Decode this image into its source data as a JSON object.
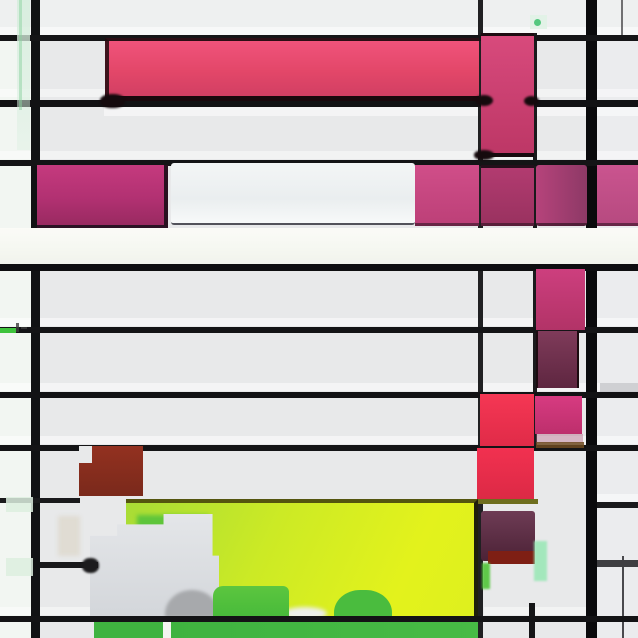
{
  "artwork": {
    "title": "Abstract Mondrian-style glitch composition",
    "canvas": {
      "width": 638,
      "height": 638,
      "background": "#e8e9ea"
    },
    "palette": {
      "ground": "#e8e9ea",
      "line_black": "#121214",
      "pink_bright": "#e84a71",
      "magenta": "#b23172",
      "red": "#ee3150",
      "brick": "#8a2d1e",
      "maroon": "#6f2f4c",
      "chartreuse": "#d8ef1f",
      "green": "#42b742",
      "white_band": "#f7f8f3",
      "mint": "#ddefe2"
    },
    "layers": [
      {
        "name": "left-column-tint",
        "x": 0,
        "y": 0,
        "w": 33,
        "h": 638,
        "css": {
          "background": "#f2f6f2"
        }
      },
      {
        "name": "right-column-tint",
        "x": 597,
        "y": 0,
        "w": 41,
        "h": 638,
        "css": {
          "background": "#ebecee"
        }
      },
      {
        "name": "top-band-tint",
        "x": 0,
        "y": 0,
        "w": 638,
        "h": 35,
        "css": {
          "background": "#eef0f0"
        }
      },
      {
        "name": "row-bevel",
        "x": 0,
        "y": 27,
        "w": 638,
        "h": 9,
        "css": {
          "background": "rgba(255,255,255,0.5)"
        }
      },
      {
        "name": "row-bevel",
        "x": 0,
        "y": 89,
        "w": 638,
        "h": 8,
        "css": {
          "background": "rgba(255,255,255,0.45)"
        }
      },
      {
        "name": "row-bevel",
        "x": 104,
        "y": 104,
        "w": 534,
        "h": 12,
        "css": {
          "background": "rgba(255,255,255,0.5)"
        }
      },
      {
        "name": "row-bevel",
        "x": 0,
        "y": 151,
        "w": 638,
        "h": 8,
        "css": {
          "background": "rgba(255,255,255,0.45)"
        }
      },
      {
        "name": "row-bevel",
        "x": 0,
        "y": 318,
        "w": 638,
        "h": 8,
        "css": {
          "background": "rgba(255,255,255,0.5)"
        }
      },
      {
        "name": "row-bevel",
        "x": 0,
        "y": 383,
        "w": 638,
        "h": 8,
        "css": {
          "background": "rgba(255,255,255,0.5)"
        }
      },
      {
        "name": "row-bevel",
        "x": 0,
        "y": 436,
        "w": 638,
        "h": 8,
        "css": {
          "background": "rgba(255,255,255,0.5)"
        }
      },
      {
        "name": "row-bevel",
        "x": 597,
        "y": 494,
        "w": 41,
        "h": 8,
        "css": {
          "background": "rgba(255,255,255,0.5)"
        }
      },
      {
        "name": "row-bevel",
        "x": 0,
        "y": 607,
        "w": 94,
        "h": 8,
        "css": {
          "background": "rgba(255,255,255,0.45)"
        }
      },
      {
        "name": "row-bevel",
        "x": 484,
        "y": 607,
        "w": 113,
        "h": 8,
        "css": {
          "background": "rgba(255,255,255,0.45)"
        }
      },
      {
        "name": "v-line-left",
        "x": 31,
        "y": 0,
        "w": 9,
        "h": 638,
        "css": {
          "background": "#111214"
        }
      },
      {
        "name": "v-line-center-thin",
        "x": 478,
        "y": 0,
        "w": 5,
        "h": 638,
        "css": {
          "background": "#202022"
        }
      },
      {
        "name": "v-line-right-thick",
        "x": 586,
        "y": 0,
        "w": 11,
        "h": 638,
        "css": {
          "background": "#0a0a0c"
        }
      },
      {
        "name": "v-line-mid-partial",
        "x": 533,
        "y": 33,
        "w": 4,
        "h": 415,
        "css": {
          "background": "#1a1a1c"
        }
      },
      {
        "name": "v-line-faint-top-right",
        "x": 621,
        "y": 0,
        "w": 2,
        "h": 37,
        "css": {
          "background": "rgba(70,70,72,0.75)"
        }
      },
      {
        "name": "v-line-faint-bottom-right",
        "x": 622,
        "y": 556,
        "w": 2,
        "h": 82,
        "css": {
          "background": "rgba(45,45,48,0.85)"
        }
      },
      {
        "name": "v-line-stub-bottom",
        "x": 529,
        "y": 603,
        "w": 6,
        "h": 35,
        "css": {
          "background": "#151517"
        }
      },
      {
        "name": "h-line-1",
        "x": 0,
        "y": 35,
        "w": 638,
        "h": 6,
        "css": {
          "background": "#151517"
        }
      },
      {
        "name": "h-line-2",
        "x": 0,
        "y": 100,
        "w": 638,
        "h": 7,
        "css": {
          "background": "#121214"
        }
      },
      {
        "name": "h-line-3",
        "x": 0,
        "y": 160,
        "w": 638,
        "h": 6,
        "css": {
          "background": "#141416"
        }
      },
      {
        "name": "h-line-6",
        "x": 0,
        "y": 327,
        "w": 638,
        "h": 6,
        "css": {
          "background": "#141416"
        }
      },
      {
        "name": "h-line-7",
        "x": 0,
        "y": 392,
        "w": 638,
        "h": 6,
        "css": {
          "background": "#121214"
        }
      },
      {
        "name": "h-line-8",
        "x": 0,
        "y": 445,
        "w": 638,
        "h": 6,
        "css": {
          "background": "#141416"
        }
      },
      {
        "name": "h-line-9-left",
        "x": 0,
        "y": 498,
        "w": 80,
        "h": 5,
        "css": {
          "background": "#1a1a1c"
        }
      },
      {
        "name": "h-line-9-right",
        "x": 597,
        "y": 502,
        "w": 41,
        "h": 6,
        "css": {
          "background": "#1a1a1c"
        }
      },
      {
        "name": "h-line-10-right",
        "x": 597,
        "y": 560,
        "w": 41,
        "h": 7,
        "css": {
          "background": "#3f3f42"
        }
      },
      {
        "name": "right-gray-bar",
        "x": 600,
        "y": 383,
        "w": 38,
        "h": 9,
        "css": {
          "background": "rgba(120,120,128,0.3)"
        }
      },
      {
        "name": "pink-bar",
        "x": 105,
        "y": 38,
        "w": 374,
        "h": 63,
        "css": {
          "background": "linear-gradient(180deg,#f0537b,#e34769 55%,#d23f63)",
          "borderTop": "3px solid #2c0e15",
          "borderBottom": "5px solid #1a090d",
          "borderLeft": "4px solid rgba(30,10,14,0.85)",
          "boxSizing": "border-box"
        }
      },
      {
        "name": "top-pink-column",
        "x": 481,
        "y": 33,
        "w": 53,
        "h": 124,
        "css": {
          "background": "linear-gradient(180deg,#d84a7c,#bd3766)",
          "borderTop": "3px solid #1c0b10",
          "borderBottom": "4px solid #170a0e",
          "boxSizing": "border-box"
        }
      },
      {
        "name": "smudge-bar-corner",
        "x": 100,
        "y": 94,
        "w": 25,
        "h": 14,
        "css": {
          "background": "#150a0d",
          "borderRadius": "45%",
          "filter": "blur(1px)"
        }
      },
      {
        "name": "smudge-cross-left",
        "x": 475,
        "y": 95,
        "w": 18,
        "h": 11,
        "css": {
          "background": "#150a0d",
          "borderRadius": "50%",
          "filter": "blur(1px)"
        }
      },
      {
        "name": "smudge-cross-right",
        "x": 524,
        "y": 96,
        "w": 15,
        "h": 10,
        "css": {
          "background": "#150a0d",
          "borderRadius": "50%",
          "filter": "blur(1px)"
        }
      },
      {
        "name": "smudge-column-bottom",
        "x": 474,
        "y": 150,
        "w": 20,
        "h": 10,
        "css": {
          "background": "#150a0d",
          "borderRadius": "45%",
          "filter": "blur(1px)"
        }
      },
      {
        "name": "mid-magenta-block",
        "x": 37,
        "y": 165,
        "w": 131,
        "h": 63,
        "css": {
          "background": "linear-gradient(180deg,#c53a7e,#b23172 55%,#992a61)",
          "borderBottom": "3px solid #2b1224",
          "borderRight": "4px solid #2a1120",
          "boxSizing": "border-box"
        }
      },
      {
        "name": "mid-light-block",
        "x": 171,
        "y": 163,
        "w": 244,
        "h": 62,
        "css": {
          "background": "linear-gradient(180deg,#f3f5f6,#eaeeef 60%,#f7f9f9)",
          "borderBottom": "2px solid #52525a",
          "borderRadius": "3px",
          "boxSizing": "border-box"
        }
      },
      {
        "name": "mid-pink-block-1",
        "x": 415,
        "y": 165,
        "w": 64,
        "h": 61,
        "css": {
          "background": "linear-gradient(180deg,#d04e89,#bd4078)",
          "borderBottom": "3px solid rgba(60,20,40,0.7)",
          "boxSizing": "border-box"
        }
      },
      {
        "name": "mid-pink-block-2",
        "x": 481,
        "y": 165,
        "w": 53,
        "h": 61,
        "css": {
          "background": "linear-gradient(180deg,#b23b70,#9a3260)",
          "borderTop": "3px solid #240f1b",
          "borderBottom": "3px solid rgba(50,18,34,0.7)",
          "boxSizing": "border-box"
        }
      },
      {
        "name": "mid-purple-block",
        "x": 536,
        "y": 165,
        "w": 51,
        "h": 61,
        "css": {
          "background": "linear-gradient(90deg,#b6437b,#8d3966)",
          "borderRadius": "3px",
          "borderBottom": "3px solid rgba(50,18,34,0.7)",
          "boxSizing": "border-box"
        }
      },
      {
        "name": "mid-pink-block-3",
        "x": 597,
        "y": 165,
        "w": 41,
        "h": 61,
        "css": {
          "background": "linear-gradient(180deg,#ca548f,#b74a80)",
          "borderBottom": "3px solid rgba(60,20,40,0.7)",
          "boxSizing": "border-box"
        }
      },
      {
        "name": "white-band",
        "x": 0,
        "y": 228,
        "w": 638,
        "h": 36,
        "css": {
          "background": "linear-gradient(180deg,#fbfbf7,#f6f8f2 50%,#f1f3ec)"
        }
      },
      {
        "name": "h-line-5",
        "x": 0,
        "y": 264,
        "w": 638,
        "h": 7,
        "css": {
          "background": "#0e0e10"
        }
      },
      {
        "name": "lower-pink-block",
        "x": 536,
        "y": 269,
        "w": 49,
        "h": 61,
        "css": {
          "background": "linear-gradient(180deg,#cd3f7e,#b23367)"
        }
      },
      {
        "name": "maroon-block",
        "x": 536,
        "y": 331,
        "w": 43,
        "h": 57,
        "css": {
          "background": "linear-gradient(180deg,#7f3b5a,#5e2640)",
          "borderLeft": "2px solid #1c0b10",
          "borderRight": "2px solid #1c0b10",
          "boxSizing": "border-box"
        }
      },
      {
        "name": "red-block-a",
        "x": 480,
        "y": 394,
        "w": 54,
        "h": 52,
        "css": {
          "background": "linear-gradient(180deg,#f53754,#e02b48)"
        }
      },
      {
        "name": "bright-pink-block",
        "x": 535,
        "y": 396,
        "w": 47,
        "h": 38,
        "css": {
          "background": "linear-gradient(180deg,#d73b81,#bd2f6c)"
        }
      },
      {
        "name": "pink-fade-strip",
        "x": 536,
        "y": 434,
        "w": 47,
        "h": 9,
        "css": {
          "background": "rgba(170,90,120,0.4)"
        }
      },
      {
        "name": "brown-line",
        "x": 536,
        "y": 442,
        "w": 48,
        "h": 6,
        "css": {
          "background": "rgba(110,74,32,0.85)"
        }
      },
      {
        "name": "red-block-b",
        "x": 477,
        "y": 448,
        "w": 57,
        "h": 52,
        "css": {
          "background": "linear-gradient(180deg,#f13150,#dc2945)"
        }
      },
      {
        "name": "brick-red-block",
        "x": 79,
        "y": 446,
        "w": 64,
        "h": 50,
        "css": {
          "background": "linear-gradient(180deg,#933120,#7a291b)"
        }
      },
      {
        "name": "brick-notch",
        "x": 79,
        "y": 446,
        "w": 13,
        "h": 17,
        "css": {
          "background": "#e8e9ea"
        }
      },
      {
        "name": "olive-line",
        "x": 477,
        "y": 499,
        "w": 61,
        "h": 5,
        "css": {
          "background": "#6e6e1e"
        }
      },
      {
        "name": "chartreuse-block",
        "x": 126,
        "y": 499,
        "w": 352,
        "h": 118,
        "css": {
          "background": "linear-gradient(115deg,#a8dc36,#ccea25 40%,#e3f21c 78%,#def01e)",
          "borderTop": "4px solid #54550f",
          "borderRight": "4px solid #1f200b",
          "boxSizing": "border-box"
        }
      },
      {
        "name": "green-underband",
        "x": 137,
        "y": 515,
        "w": 72,
        "h": 18,
        "css": {
          "background": "rgba(85,194,60,0.9)",
          "filter": "blur(2px)"
        }
      },
      {
        "name": "gray-step-shape",
        "x": 90,
        "y": 514,
        "w": 129,
        "h": 104,
        "css": {
          "background": "linear-gradient(180deg,#e4e6e9,#d3d6da)",
          "clipPath": "polygon(0% 21%,21% 21%,21% 10%,57% 10%,57% 0%,95% 0%,95% 40%,100% 40%,100% 100%,0% 100%)"
        }
      },
      {
        "name": "beige-smudge",
        "x": 58,
        "y": 516,
        "w": 22,
        "h": 40,
        "css": {
          "background": "rgba(216,209,192,0.55)",
          "filter": "blur(2px)"
        }
      },
      {
        "name": "purple-bottom-block",
        "x": 481,
        "y": 511,
        "w": 54,
        "h": 50,
        "css": {
          "background": "linear-gradient(180deg,#6e3c55,#4c2236)",
          "borderRadius": "3px"
        }
      },
      {
        "name": "dark-red-patch",
        "x": 488,
        "y": 551,
        "w": 47,
        "h": 13,
        "css": {
          "background": "#7e1f14"
        }
      },
      {
        "name": "mint-sliver-right",
        "x": 534,
        "y": 541,
        "w": 13,
        "h": 40,
        "css": {
          "background": "rgba(150,230,180,0.85)",
          "filter": "blur(1px)"
        }
      },
      {
        "name": "green-sliver-left",
        "x": 482,
        "y": 563,
        "w": 8,
        "h": 26,
        "css": {
          "background": "rgba(80,196,55,0.9)",
          "filter": "blur(1px)"
        }
      },
      {
        "name": "gray-blob",
        "x": 165,
        "y": 590,
        "w": 54,
        "h": 28,
        "css": {
          "background": "#a7a9ac",
          "borderRadius": "50% 50% 0 0 / 85% 85% 0 0",
          "filter": "blur(1.5px)"
        }
      },
      {
        "name": "white-blob",
        "x": 283,
        "y": 607,
        "w": 44,
        "h": 13,
        "css": {
          "background": "#edefeb",
          "borderRadius": "50%",
          "filter": "blur(2px)"
        }
      },
      {
        "name": "green-patch",
        "x": 213,
        "y": 586,
        "w": 76,
        "h": 34,
        "css": {
          "background": "linear-gradient(180deg,#5cc63f,#46b93a)",
          "borderRadius": "10px 6px 0 0"
        }
      },
      {
        "name": "green-mound",
        "x": 334,
        "y": 590,
        "w": 58,
        "h": 30,
        "css": {
          "background": "#4abc3e",
          "borderRadius": "45% 45% 0 0 / 75% 75% 0 0"
        }
      },
      {
        "name": "h-line-10-left",
        "x": 40,
        "y": 562,
        "w": 58,
        "h": 6,
        "css": {
          "background": "#19191b"
        }
      },
      {
        "name": "line-end-blob",
        "x": 82,
        "y": 558,
        "w": 17,
        "h": 15,
        "css": {
          "background": "#1c1b1d",
          "borderRadius": "45%",
          "filter": "blur(1px)"
        }
      },
      {
        "name": "h-line-bottom",
        "x": 0,
        "y": 616,
        "w": 638,
        "h": 6,
        "css": {
          "background": "#131315"
        }
      },
      {
        "name": "green-band-left",
        "x": 94,
        "y": 622,
        "w": 69,
        "h": 16,
        "css": {
          "background": "#3fb340"
        }
      },
      {
        "name": "band-gap",
        "x": 163,
        "y": 622,
        "w": 8,
        "h": 16,
        "css": {
          "background": "#f4f5f1"
        }
      },
      {
        "name": "green-band-main",
        "x": 171,
        "y": 622,
        "w": 307,
        "h": 16,
        "css": {
          "background": "linear-gradient(90deg,#3fb340,#47bb45)"
        }
      },
      {
        "name": "mint-left-sliver",
        "x": 17,
        "y": 0,
        "w": 13,
        "h": 150,
        "css": {
          "background": "linear-gradient(180deg,rgba(214,238,221,0.9),rgba(214,238,221,0.35))"
        }
      },
      {
        "name": "mint-left-line",
        "x": 19,
        "y": 0,
        "w": 3,
        "h": 110,
        "css": {
          "background": "rgba(140,210,160,0.5)"
        }
      },
      {
        "name": "mint-tick",
        "x": 530,
        "y": 15,
        "w": 17,
        "h": 14,
        "css": {
          "background": "rgba(224,242,230,0.9)"
        }
      },
      {
        "name": "green-dot",
        "x": 534,
        "y": 19,
        "w": 7,
        "h": 7,
        "css": {
          "background": "#54c87f",
          "borderRadius": "50%"
        }
      },
      {
        "name": "green-dash",
        "x": 0,
        "y": 328,
        "w": 16,
        "h": 5,
        "css": {
          "background": "#3ec33c"
        }
      },
      {
        "name": "glyph-mark-a",
        "x": 16,
        "y": 323,
        "w": 3,
        "h": 9,
        "css": {
          "background": "rgba(60,60,60,0.8)"
        }
      },
      {
        "name": "glyph-mark-b",
        "x": 21,
        "y": 327,
        "w": 6,
        "h": 2,
        "css": {
          "background": "rgba(60,60,60,0.8)"
        }
      },
      {
        "name": "mint-wash-1",
        "x": 6,
        "y": 497,
        "w": 27,
        "h": 15,
        "css": {
          "background": "rgba(221,239,223,0.85)"
        }
      },
      {
        "name": "mint-wash-2",
        "x": 6,
        "y": 558,
        "w": 27,
        "h": 18,
        "css": {
          "background": "rgba(221,239,223,0.85)"
        }
      }
    ]
  }
}
